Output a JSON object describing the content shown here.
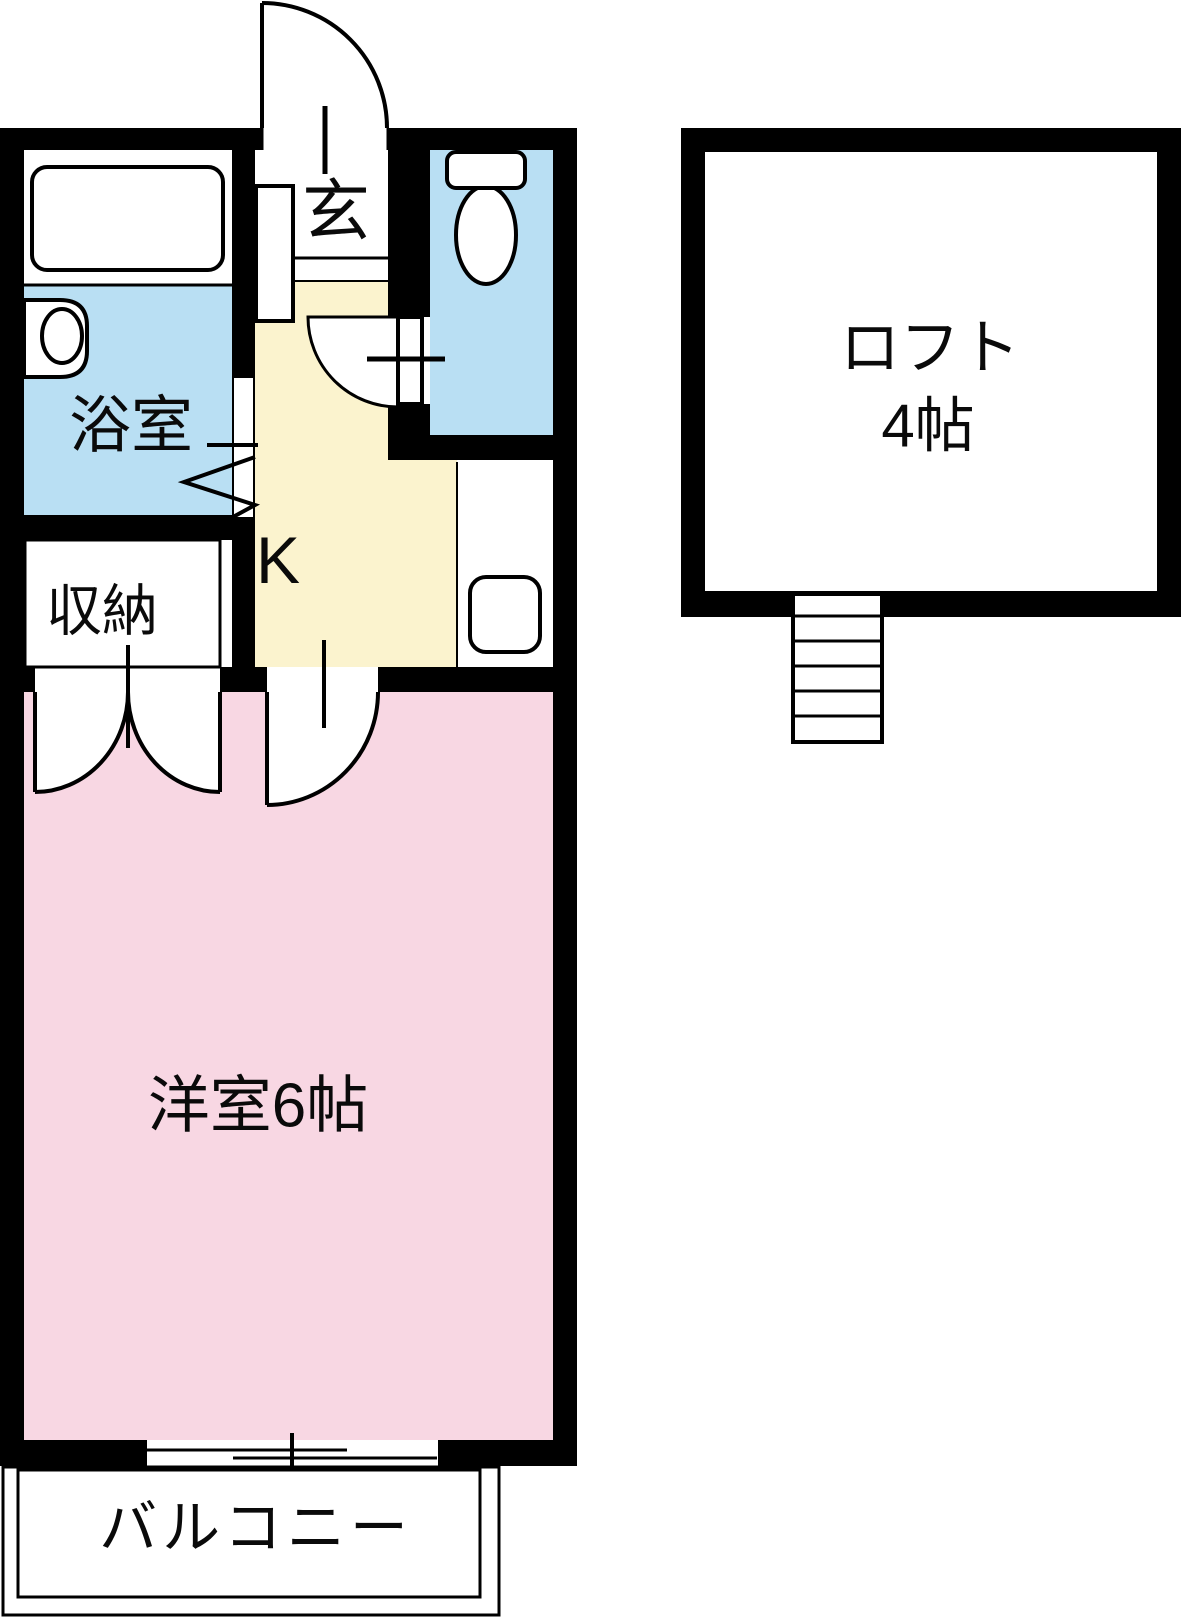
{
  "plan": {
    "type": "apartment-floor-plan",
    "rooms": {
      "bathroom": {
        "label": "浴室"
      },
      "entrance": {
        "label": "玄"
      },
      "storage": {
        "label": "収納"
      },
      "kitchen": {
        "label": "K"
      },
      "western_room": {
        "label": "洋室6帖"
      },
      "balcony": {
        "label": "バルコニー"
      },
      "loft": {
        "label_line1": "ロフト",
        "label_line2": "4帖"
      }
    },
    "colors": {
      "wall": "#000000",
      "water_blue": "#b9dff3",
      "kitchen_yellow": "#fbf3ce",
      "room_pink": "#f8d7e3",
      "fixture_white": "#ffffff"
    }
  }
}
